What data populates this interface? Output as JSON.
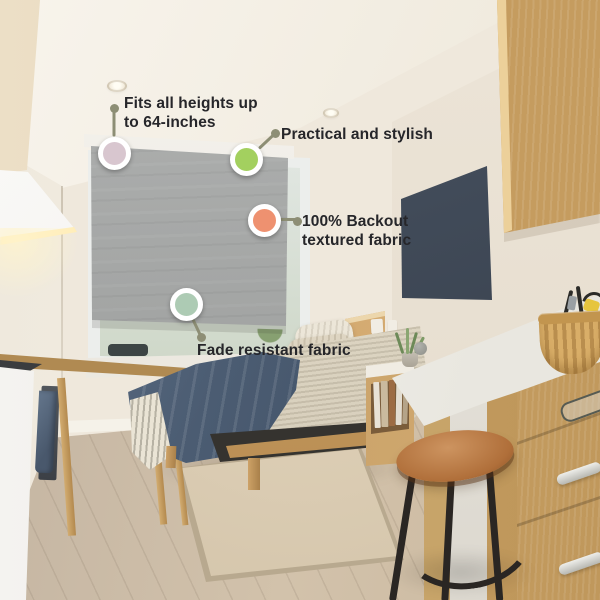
{
  "image_type": "product-feature callout photo",
  "scene_description": "Studio apartment bedroom: grey blackout roller shade over window above a bed, kitchenette at left, oak cabinets and white desk counter with stool at right",
  "callouts": [
    {
      "id": "fits-all-heights",
      "line1": "Fits all heights up",
      "line2": "to 64-inches",
      "marker_color": "#d8c6cf"
    },
    {
      "id": "practical-stylish",
      "line1": "Practical and stylish",
      "marker_color": "#a3d05f"
    },
    {
      "id": "blackout-fabric",
      "line1": "100% Backout",
      "line2": "textured fabric",
      "marker_color": "#ee9170"
    },
    {
      "id": "fade-resistant",
      "line1": "Fade resistant fabric",
      "marker_color": "#adcbb4"
    }
  ],
  "colors": {
    "leader_line": "#8d8e75",
    "callout_text": "#26262a",
    "shade_fabric": "#a7a9a8"
  }
}
